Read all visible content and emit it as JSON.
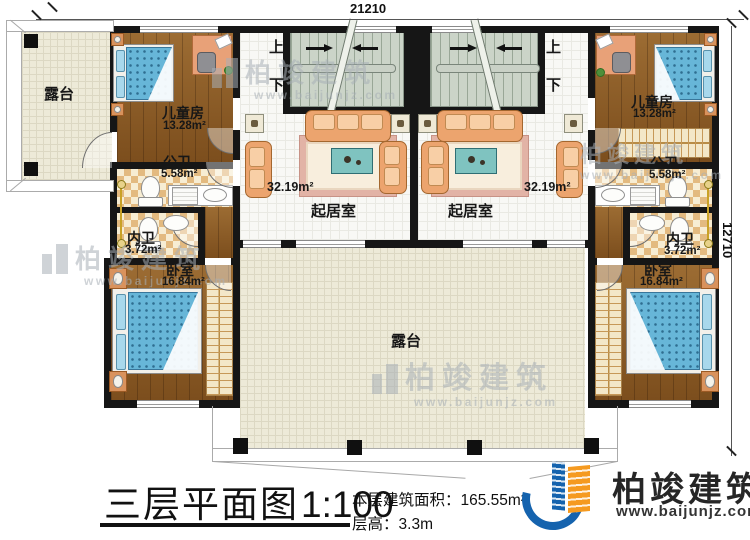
{
  "dims": {
    "top": "21210",
    "right": "12710"
  },
  "stairs": {
    "up": "上",
    "down": "下"
  },
  "rooms": {
    "terrace": "露台",
    "child": "儿童房",
    "child_area": "13.28m²",
    "pub_bath": "公卫",
    "pub_bath_area": "5.58m²",
    "priv_bath": "内卫",
    "priv_bath_area": "3.72m²",
    "bedroom": "卧室",
    "bedroom_area": "16.84m²",
    "living": "起居室",
    "living_area": "32.19m²"
  },
  "titleblock": {
    "title": "三层平面图",
    "scale": "1:100",
    "area_label": "本层建筑面积：",
    "area_value": "165.55m²",
    "height_label": "层高：",
    "height_value": "3.3m"
  },
  "brand": {
    "name": "柏竣建筑",
    "site": "www.baijunjz.com"
  }
}
